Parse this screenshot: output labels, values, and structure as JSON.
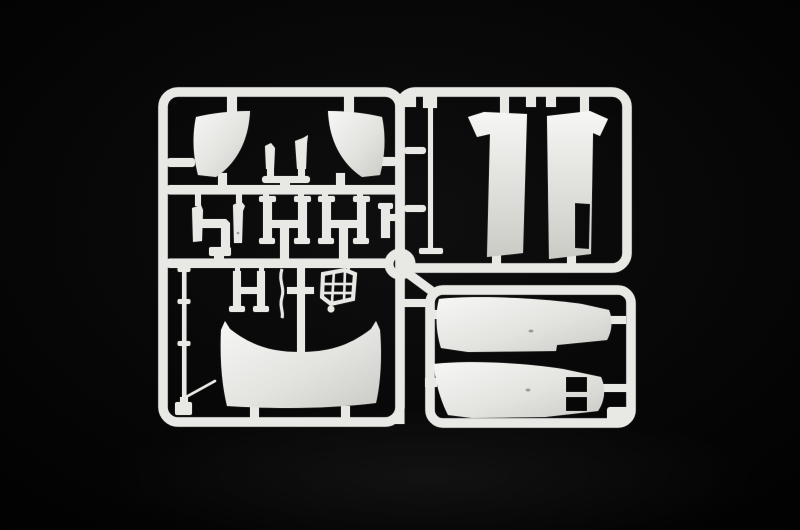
{
  "scene": {
    "description": "Studio photograph of an injection-moulded polystyrene model-kit sprue (parts tree) in light grey plastic, lying on a black backdrop",
    "kit_subject": "truck cab body panels sprue",
    "background_style": "black studio backdrop with faint vignette"
  },
  "colors": {
    "background": "#030303",
    "vignette_center": "#0f0f0f",
    "plastic": "#e8e8e5",
    "plastic_light": "#f6f6f4",
    "plastic_mid": "#e3e3e0",
    "plastic_shadow": "#cbcbc6",
    "plastic_dark": "#9a9a94"
  },
  "parts": {
    "frame": "sprue outer frame and runner bars",
    "hub_ring": "circular runner hub ring",
    "left_fender": "wheel-arch fender panel (left)",
    "right_fender": "wheel-arch fender panel (right)",
    "pillar_trim_a": "pillar trim strip",
    "pillar_trim_b": "pillar trim strip with bent tip",
    "trim_stand": "trim mounting stand",
    "bracket_strip_a": "mounting strip bracket",
    "bracket_elbow": "elbow tube bracket",
    "bracket_strip_b": "mounting strip bracket with bent tip",
    "bracket_strip_c": "small mounting strip",
    "hinge_frame_a": "hinge bracket frame",
    "hinge_frame_b": "hinge bracket frame",
    "step_frame": "step bracket frame",
    "linkage_rod": "thin curved linkage rod",
    "cross_bracket": "cross-shaped bracket",
    "grille_lattice": "latticed step grille",
    "front_visor_panel": "wide curved front visor panel",
    "antenna_rod": "long collared rod",
    "antenna_whip": "thin whip rod",
    "wiper_rod": "long flat-footed rod",
    "cab_panel_left": "tall cab corner panel with top deflector",
    "cab_panel_right": "tall cab corner panel with window opening",
    "side_skirt_upper": "long side-skirt fairing panel",
    "side_skirt_lower": "long side-skirt fairing panel with twin vent openings"
  }
}
